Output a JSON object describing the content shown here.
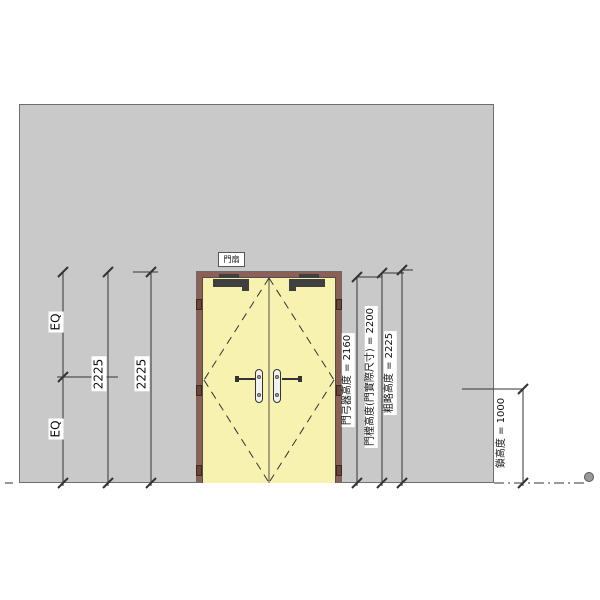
{
  "canvas": {
    "width": 600,
    "height": 600
  },
  "door_tag": {
    "label": "門扇"
  },
  "dimensions": {
    "left": {
      "eq_upper": "EQ",
      "eq_lower": "EQ",
      "overall_height_inner": "2225",
      "overall_height_outer": "2225"
    },
    "right": {
      "door_closer_height": "門弓器高度 = 2160",
      "door_height_actual": "門樘高度(門實際尺寸) = 2200",
      "rough_height": "粗略高度 = 2225",
      "lock_height": "鎖高度 = 1000"
    }
  },
  "colors": {
    "wall": "#c9c9c9",
    "wall_border": "#6e6e6e",
    "door_frame": "#8d6055",
    "door_leaf": "#f8f2b0",
    "line": "#333333",
    "hardware": "#3f3f3f",
    "label_bg": "#ffffff"
  }
}
